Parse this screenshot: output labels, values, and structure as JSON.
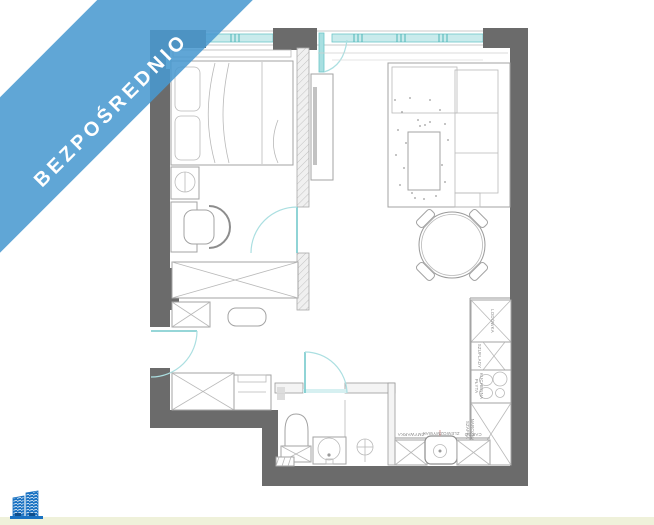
{
  "banner": {
    "label": "BEZPOŚREDNIO",
    "background": "#4899d0",
    "text_color": "#ffffff"
  },
  "logo": {
    "icon": "buildings-logo",
    "color": "#1a72c2"
  },
  "page": {
    "background": "#ffffff",
    "footer_strip_color": "#eff1da"
  },
  "floorplan": {
    "type": "apartment-floor-plan",
    "colors": {
      "wall": "#6b6b6b",
      "furniture_line": "#a3a3a3",
      "opening_teal": "#74c9cc",
      "label_gray": "#8a8a8a"
    },
    "labels": {
      "fridge": "LODÓWKA",
      "drawers": "SZUFLADY",
      "hob_line1": "PŁYTA",
      "hob_line2": "KUCHENNA",
      "corner_cabinet_line1": "SZAFKA",
      "corner_cabinet_line2": "NAROŻNA",
      "dishwasher": "ZMYWARKA",
      "sink": "ZLEWOZMYWAK",
      "cargo": "CARGO"
    }
  }
}
